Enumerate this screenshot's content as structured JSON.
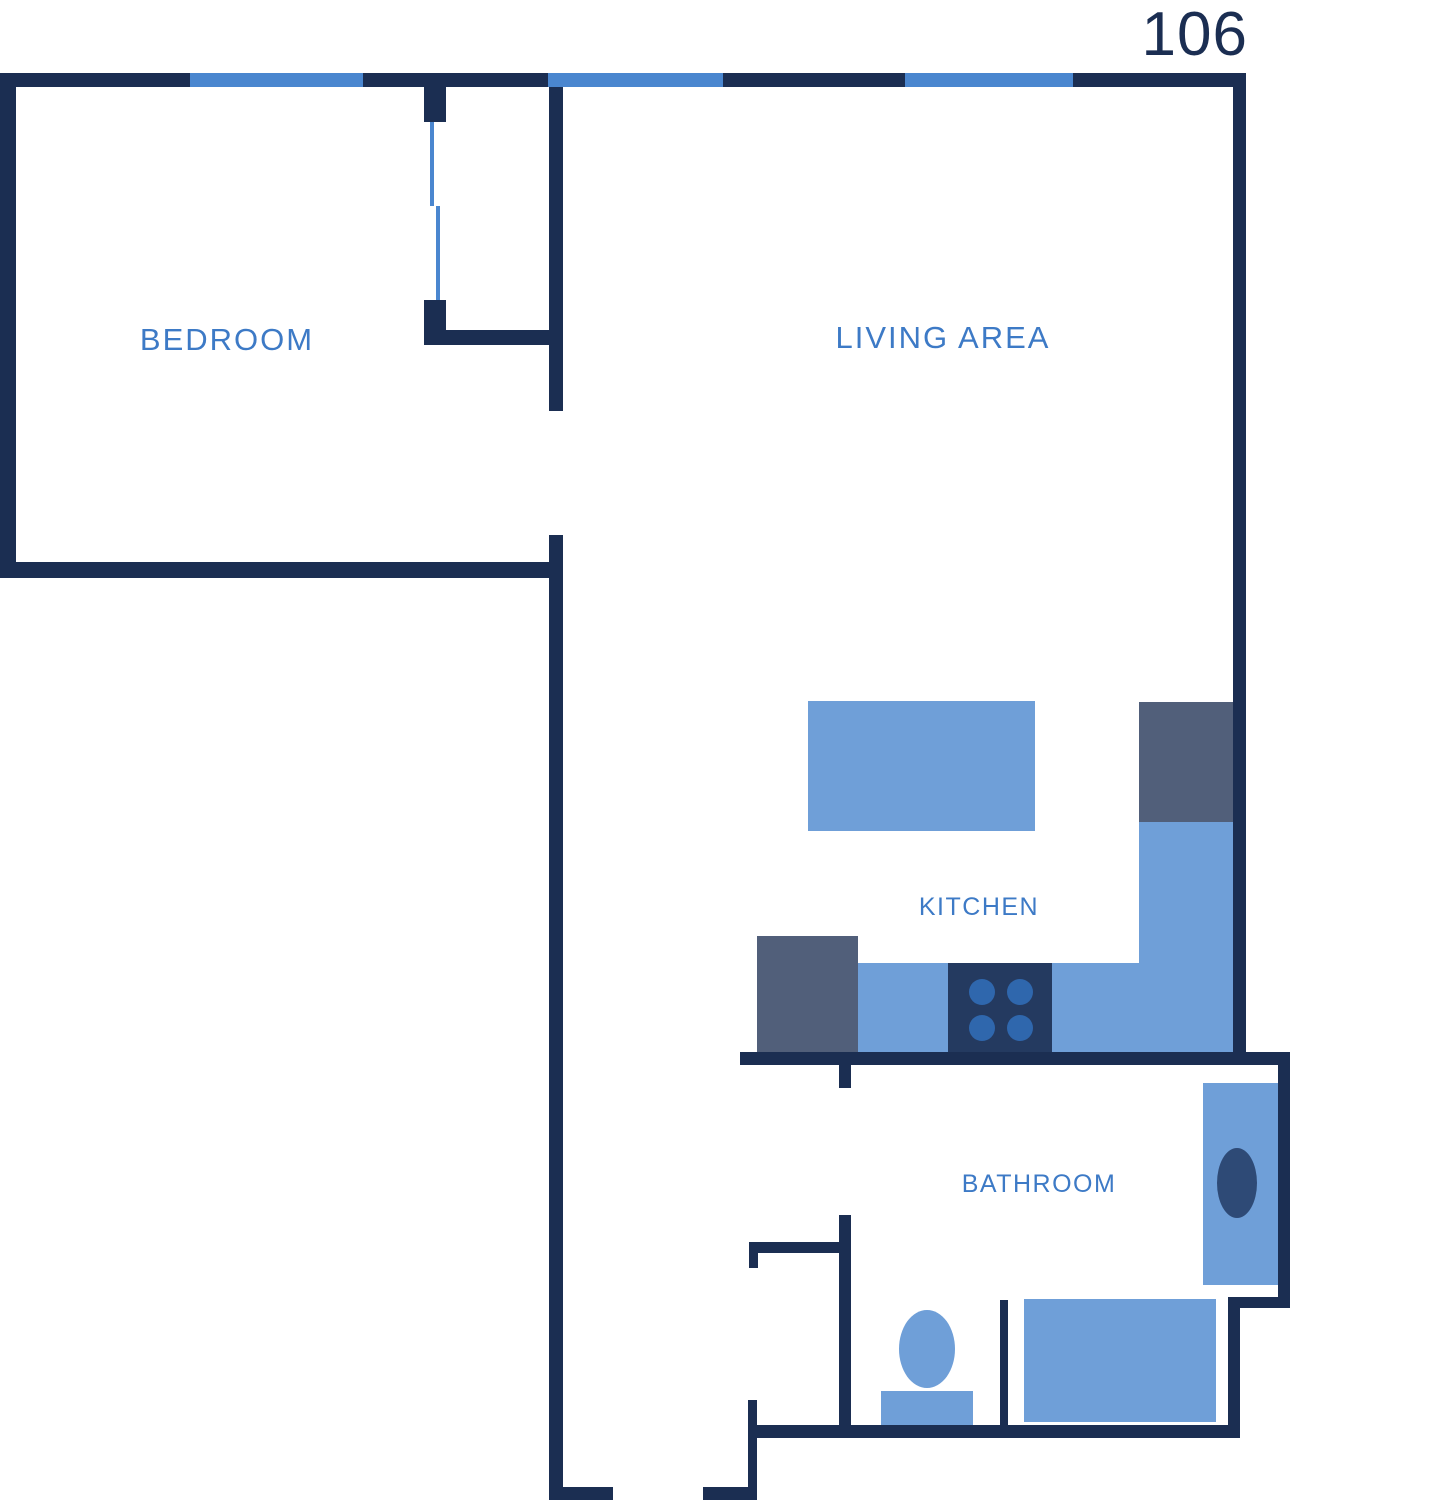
{
  "unit_number": "106",
  "labels": {
    "bedroom": "BEDROOM",
    "living_area": "LIVING AREA",
    "kitchen": "KITCHEN",
    "bathroom": "BATHROOM"
  },
  "colors": {
    "wall": "#1b2e52",
    "window": "#4a86cf",
    "fixture": "#6f9fd8",
    "slate": "#515f7a",
    "stove": "#243a60",
    "burner": "#2f67ad",
    "sink": "#2e4a76",
    "label": "#3d7ac6",
    "unit": "#1b2e52",
    "bg": "#ffffff"
  },
  "fixtures": [
    "kitchen-island",
    "upper-cabinet",
    "counter-column",
    "counter-row",
    "refrigerator",
    "stove",
    "bathroom-vanity",
    "vanity-sink",
    "bathtub",
    "toilet-bowl",
    "toilet-tank"
  ]
}
